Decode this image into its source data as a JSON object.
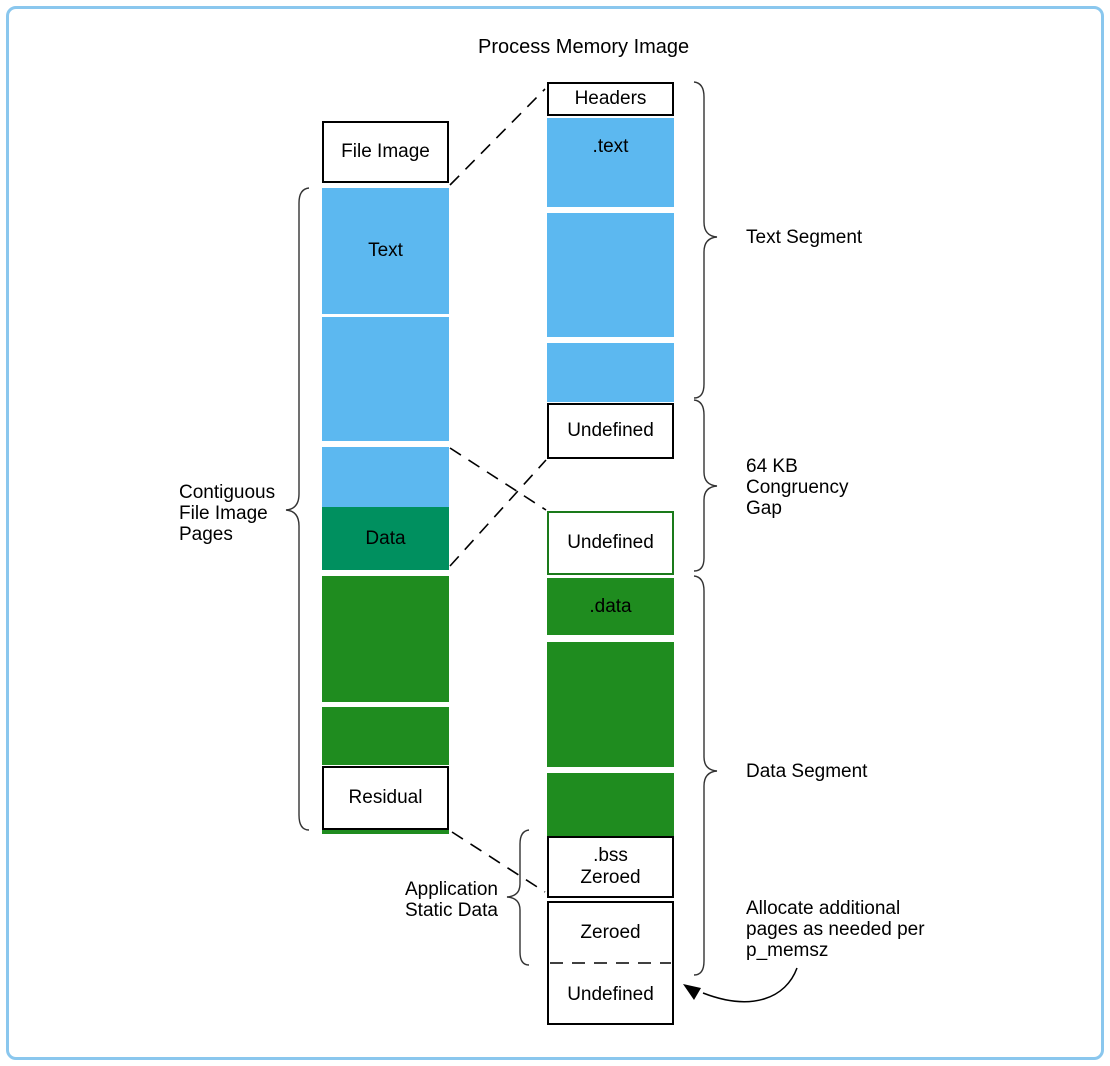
{
  "diagram": {
    "title": "Process Memory Image",
    "file_image": {
      "label_box": "File Image",
      "text_label": "Text",
      "data_label": "Data",
      "residual_label": "Residual"
    },
    "memory_image": {
      "headers": "Headers",
      "text_section": ".text",
      "undefined_top": "Undefined",
      "undefined_mid": "Undefined",
      "data_section": ".data",
      "bss_line1": ".bss",
      "bss_line2": "Zeroed",
      "zeroed": "Zeroed",
      "undefined_bottom": "Undefined"
    },
    "labels": {
      "contiguous1": "Contiguous",
      "contiguous2": "File Image",
      "contiguous3": "Pages",
      "text_segment": "Text Segment",
      "gap1": "64 KB",
      "gap2": "Congruency",
      "gap3": "Gap",
      "data_segment": "Data Segment",
      "app_static1": "Application",
      "app_static2": "Static Data",
      "allocate1": "Allocate additional",
      "allocate2": "pages as needed per",
      "allocate3": "p_memsz"
    },
    "colors": {
      "block_blue": "#5CB8F0",
      "block_teal": "#00905F",
      "block_green": "#1F8C1F",
      "frame_blue": "#8AC7EE",
      "undefined_mid_border": "#1a7a1a"
    }
  }
}
